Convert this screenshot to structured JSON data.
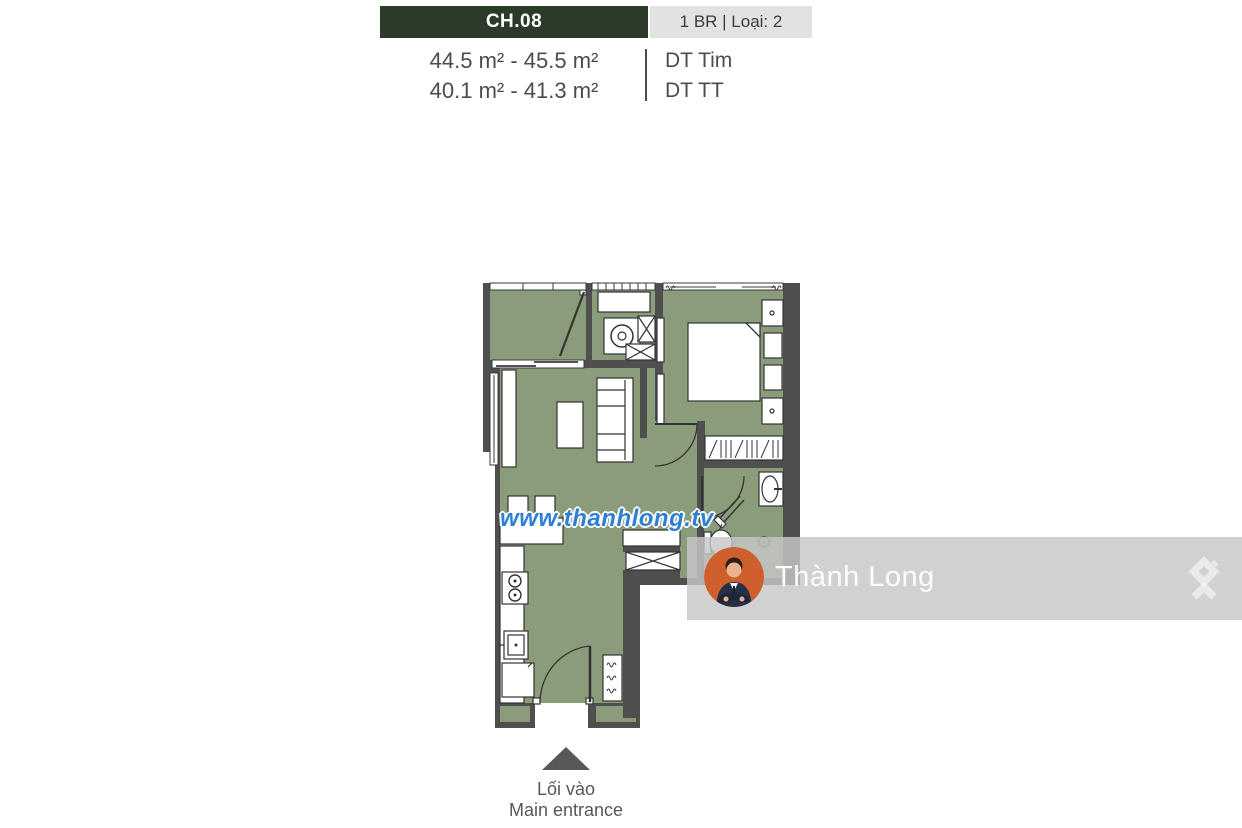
{
  "header": {
    "unit_code": "CH.08",
    "unit_type": "1 BR | Loại: 2",
    "area_tim": "44.5 m² - 45.5 m²",
    "area_tt": "40.1 m² - 41.3 m²",
    "area_tim_label": "DT Tim",
    "area_tt_label": "DT TT",
    "unit_code_bg": "#2c3a2a",
    "unit_type_bg": "#e2e2e2"
  },
  "watermark": {
    "text": "www.thanhlong.tv",
    "color": "#2e7fd6"
  },
  "agent_banner": {
    "name": "Thành Long",
    "background": "#c7c7c7",
    "avatar_bg": "#cf5f2c",
    "logo_icon": "stacked-chevron-home-icon"
  },
  "entrance": {
    "label_vi": "Lối vào",
    "label_en": "Main entrance"
  },
  "floor_plan": {
    "wall_color": "#4f4f4f",
    "floor_color": "#8b9c7b",
    "rooms": [
      "balcony",
      "laundry",
      "bedroom",
      "living-dining",
      "bathroom",
      "kitchen",
      "entry"
    ],
    "furniture": [
      "washing-machine",
      "ac-units",
      "double-bed",
      "nightstands",
      "pillows",
      "wardrobe",
      "tv-cabinet",
      "sofa",
      "coffee-table",
      "dining-set",
      "kitchen-counter",
      "stove",
      "kitchen-sink",
      "refrigerator",
      "shoe-cabinet",
      "vanity-sink",
      "toilet",
      "shower",
      "entrance-door"
    ]
  }
}
